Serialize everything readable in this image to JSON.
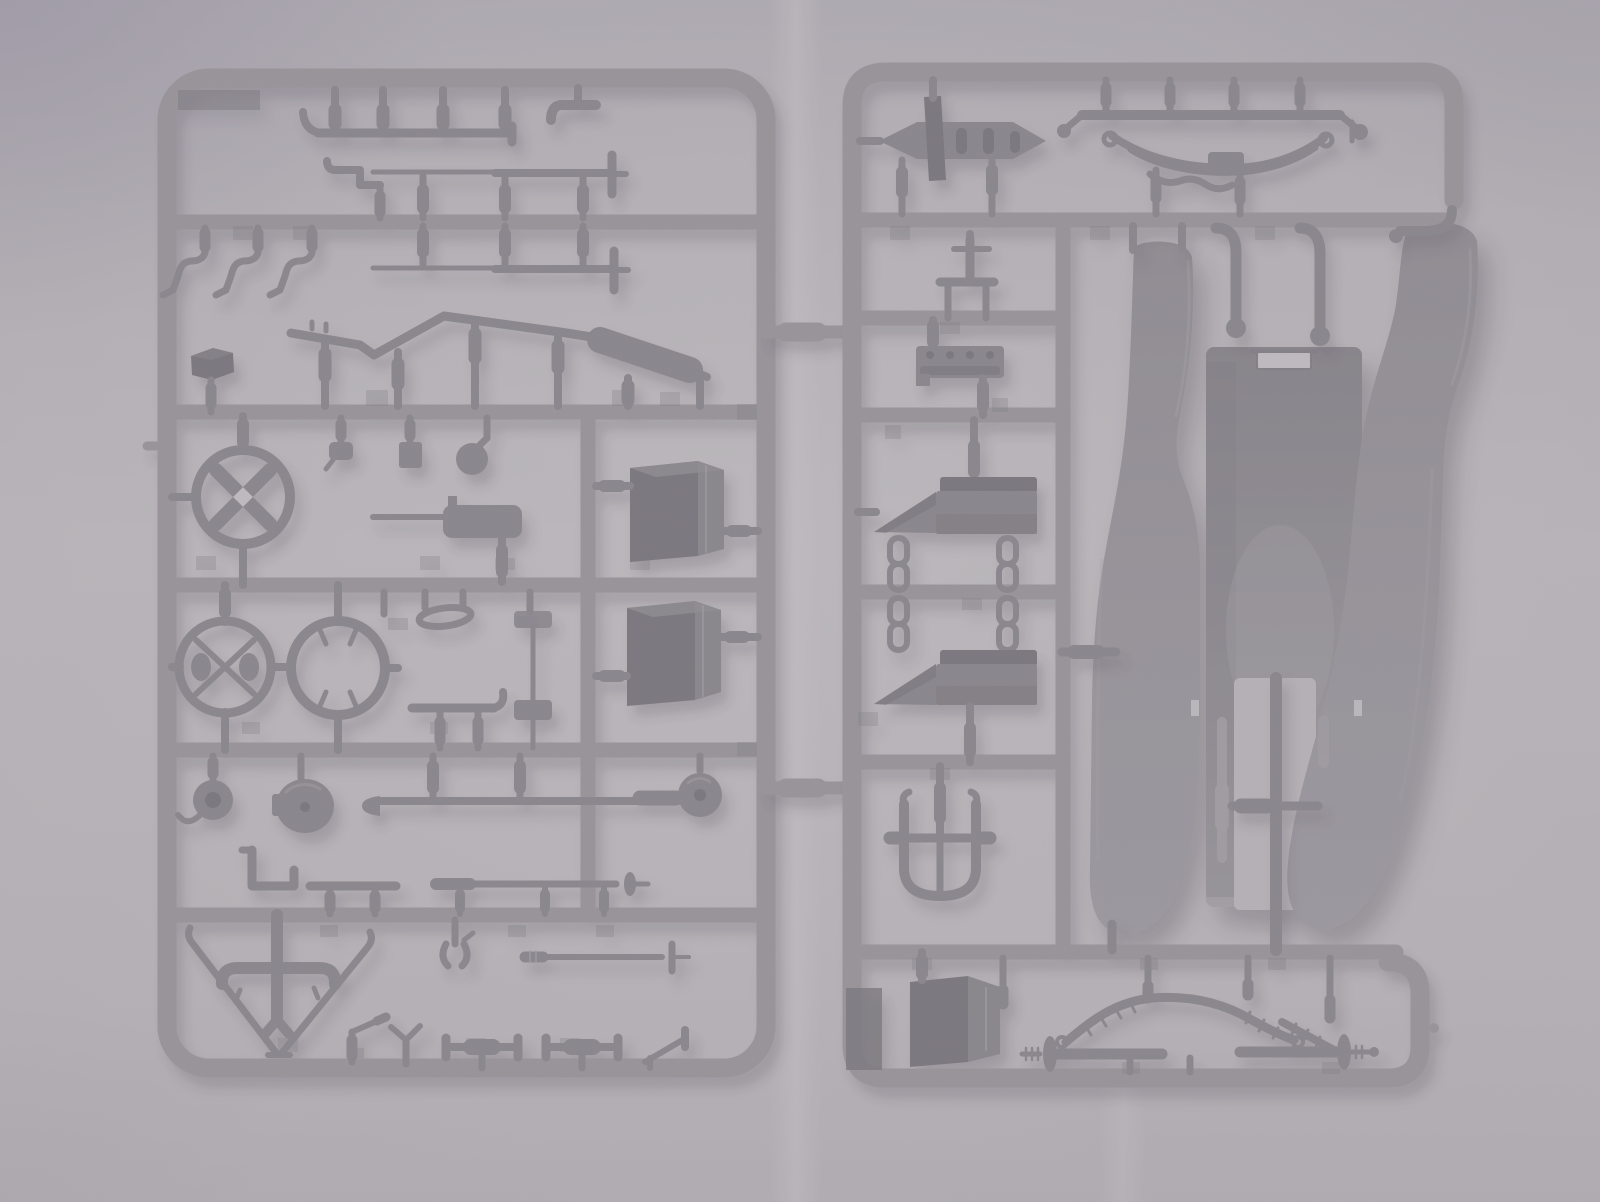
{
  "photo": {
    "subject": "Plastic scale-model kit sprues",
    "description": "Overhead photograph of two dark-gray injection-molded polystyrene sprues (part runners) of a vintage vehicle model kit, lying side by side on a pale gray paper backdrop with a vertical fold crease between them and soft vignetted lighting.",
    "sprues": {
      "left": {
        "label": "Left sprue with small detail parts",
        "parts": [
          "pin comb rack",
          "elbow pipe",
          "tapered tie rod upper",
          "step bracket",
          "tapered tie rod lower",
          "three crank hook levers",
          "small stowage box",
          "exhaust pipe with muffler",
          "valve fitting",
          "bulb horn",
          "x-spoke steering wheel",
          "machine gun with cooling jacket",
          "fuel tank box upper",
          "fuel tank box lower",
          "spoked wheel with hub caps",
          "wheel rim ring",
          "oval grab loop",
          "curl-end bar",
          "pulley with hook",
          "bell dome horn",
          "torque tube with ball end",
          "crank pipe",
          "flat bar",
          "rod with spindle finial",
          "v-shaped frame brace",
          "clevis fork",
          "banded rod with finial",
          "two stub-axle tees",
          "three angled levers"
        ]
      },
      "right": {
        "label": "Right sprue with body panels and axles",
        "parts": [
          "transmission housing",
          "front axle with leaf spring",
          "shackle bracket",
          "engine block",
          "two seat riser wedge blocks",
          "four chain links",
          "u-shaped tow bracket",
          "tool box",
          "kingpin",
          "rear axle halves with leaf spring",
          "body floor panel with slot",
          "left rear fender",
          "right rear fender",
          "two exhaust pipes",
          "axle cross rod"
        ]
      },
      "connectors": {
        "label": "Two molded bridges joining the sprues",
        "count": 2
      }
    }
  },
  "colors": {
    "bg": "#b4b0b5",
    "bgLight": "#c7c3c8",
    "bgDark": "#8e8894",
    "runner": "#7d7980",
    "part": "#635f67",
    "partDark": "#46434c",
    "boxSide": "#615e66",
    "panel": "#767279",
    "panelLight": "#8f8b92",
    "crease": "#cdc9ce",
    "shadow": "#37333f"
  }
}
